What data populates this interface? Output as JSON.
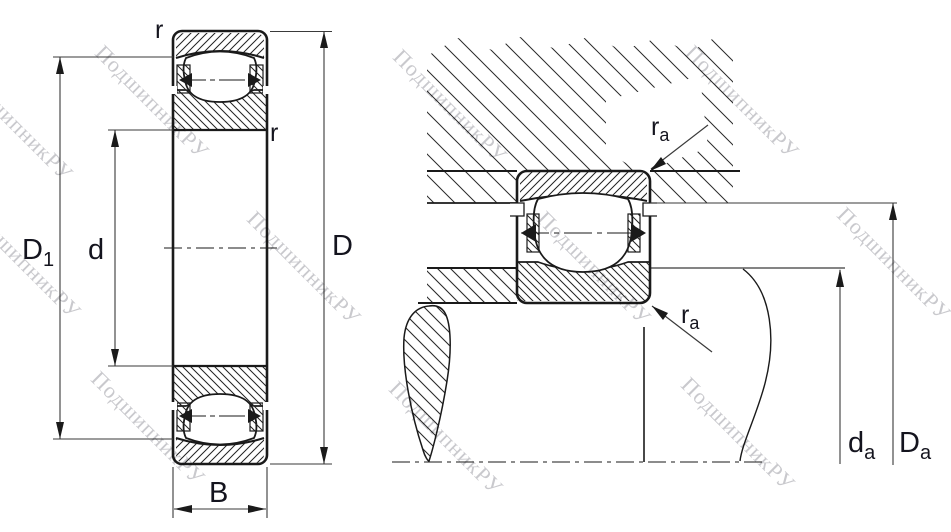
{
  "figure": {
    "description": "Barrel roller bearing cross-section drawing with mounting abutment view",
    "watermark": {
      "text": "ПодшипникРУ"
    },
    "colors": {
      "background": "#ffffff",
      "outline": "#1a1a1a",
      "hatch": "#222222",
      "dimension_line": "#3a3a3a",
      "label": "#14141e",
      "watermark": "#c3c3c8"
    },
    "left_view": {
      "labels": {
        "r_top": "r",
        "r_side": "r",
        "D1": {
          "main": "D",
          "sub": "1"
        },
        "d": "d",
        "D": "D",
        "B": "B"
      }
    },
    "right_view": {
      "labels": {
        "ra_top": {
          "main": "r",
          "sub": "a"
        },
        "ra_bottom": {
          "main": "r",
          "sub": "a"
        },
        "da": {
          "main": "d",
          "sub": "a"
        },
        "Da": {
          "main": "D",
          "sub": "a"
        }
      }
    }
  }
}
